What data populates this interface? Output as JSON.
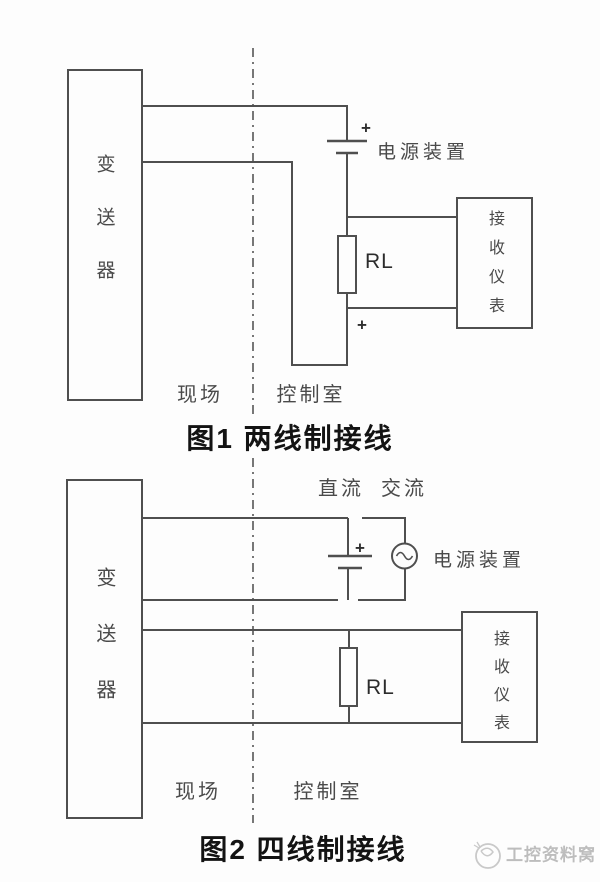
{
  "figure1": {
    "transmitter": "变送器",
    "receiver": "接收仪表",
    "plus_top": "+",
    "plus_bottom": "+",
    "power_label": "电源装置",
    "rl_label": "RL",
    "field_label": "现场",
    "control_room_label": "控制室",
    "caption": "图1 两线制接线"
  },
  "figure2": {
    "transmitter": "变送器",
    "receiver": "接收仪表",
    "dc_label": "直流",
    "ac_label": "交流",
    "plus": "+",
    "power_label": "电源装置",
    "rl_label": "RL",
    "field_label": "现场",
    "control_room_label": "控制室",
    "caption": "图2 四线制接线"
  },
  "watermark": {
    "text": "工控资料窝"
  },
  "colors": {
    "line": "#4f4f4f",
    "divider": "#565656",
    "label_text": "#4a4a4a",
    "title_text": "#131313",
    "watermark": "#bdbdbd",
    "background": "#fdfdfd"
  }
}
